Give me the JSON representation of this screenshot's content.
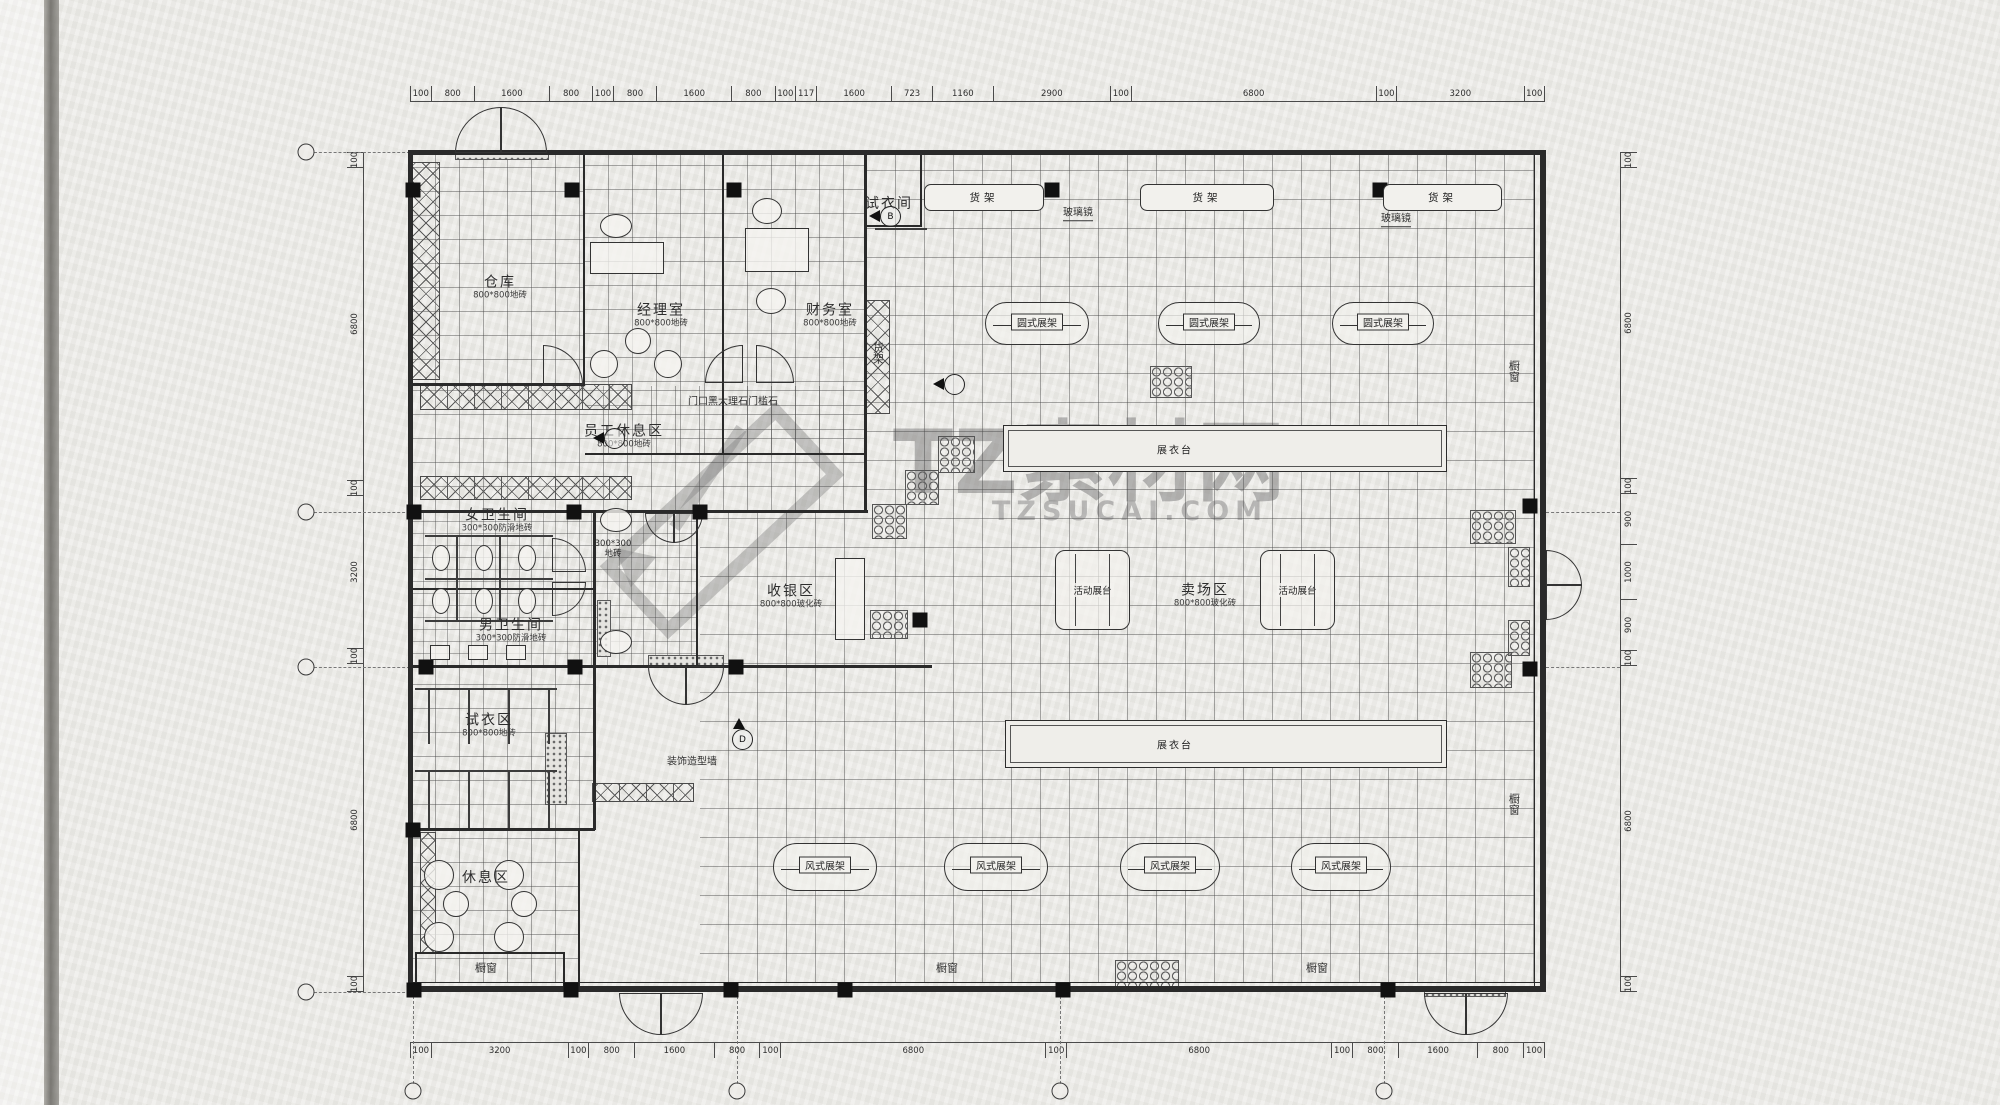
{
  "watermark": {
    "brand": "TZ素材网",
    "site": "TZSUCAI.COM",
    "logo": "pencil-icon"
  },
  "dimensions": {
    "top": [
      "100",
      "800",
      "1600",
      "800",
      "100",
      "800",
      "1600",
      "800",
      "100",
      "117",
      "1600",
      "723",
      "1160",
      "2900",
      "100",
      "6800",
      "100",
      "3200",
      "100"
    ],
    "bottom": [
      "100",
      "3200",
      "100",
      "800",
      "1600",
      "800",
      "100",
      "6800",
      "100",
      "6800",
      "100",
      "800",
      "1600",
      "800",
      "100"
    ],
    "left": [
      "100",
      "6800",
      "100",
      "3200",
      "100",
      "6800",
      "100"
    ],
    "right": [
      "100",
      "6800",
      "100",
      "900",
      "1000",
      "900",
      "100",
      "6800",
      "100"
    ]
  },
  "rooms": [
    {
      "id": "warehouse",
      "label": "仓库",
      "sub": "800*800地砖",
      "lx": 500,
      "ly": 288
    },
    {
      "id": "manager-office",
      "label": "经理室",
      "sub": "800*800地砖",
      "lx": 661,
      "ly": 316
    },
    {
      "id": "finance-office",
      "label": "财务室",
      "sub": "800*800地砖",
      "lx": 830,
      "ly": 316
    },
    {
      "id": "staff-lounge",
      "label": "员工休息区",
      "sub": "800*800地砖",
      "lx": 624,
      "ly": 437
    },
    {
      "id": "women-restroom",
      "label": "女卫生间",
      "sub": "300*300防滑地砖",
      "lx": 497,
      "ly": 521
    },
    {
      "id": "men-restroom",
      "label": "男卫生间",
      "sub": "300*300防滑地砖",
      "lx": 511,
      "ly": 631
    },
    {
      "id": "cashier-area",
      "label": "收银区",
      "sub": "800*800玻化砖",
      "lx": 791,
      "ly": 597
    },
    {
      "id": "fitting-area",
      "label": "试衣区",
      "sub": "800*800地砖",
      "lx": 489,
      "ly": 726
    },
    {
      "id": "lounge-area",
      "label": "休息区",
      "sub": "",
      "lx": 486,
      "ly": 879
    },
    {
      "id": "sales-area",
      "label": "卖场区",
      "sub": "800*800玻化砖",
      "lx": 1205,
      "ly": 596
    },
    {
      "id": "fitting-room",
      "label": "试衣间",
      "sub": "",
      "lx": 889,
      "ly": 205
    }
  ],
  "corridor_note": {
    "text": "300*300\n地砖",
    "x": 613,
    "y": 550
  },
  "notes": [
    {
      "id": "threshold-note",
      "text": "门口黑大理石门槛石",
      "x": 733,
      "y": 402,
      "fs": 10
    },
    {
      "id": "decor-wall-note",
      "text": "装饰造型墙",
      "x": 692,
      "y": 762,
      "fs": 10
    },
    {
      "id": "shelf-note-vertical",
      "text": "货架",
      "x": 877,
      "y": 353,
      "fs": 11,
      "vertical": true
    },
    {
      "id": "mirror-note-1",
      "text": "玻璃镜",
      "x": 1078,
      "y": 214,
      "fs": 10,
      "underline": true
    },
    {
      "id": "mirror-note-2",
      "text": "玻璃镜",
      "x": 1396,
      "y": 220,
      "fs": 10,
      "underline": true
    },
    {
      "id": "window-note-1",
      "text": "橱窗",
      "x": 486,
      "y": 969,
      "fs": 11
    },
    {
      "id": "window-note-2",
      "text": "橱窗",
      "x": 947,
      "y": 969,
      "fs": 11
    },
    {
      "id": "window-note-3",
      "text": "橱窗",
      "x": 1317,
      "y": 969,
      "fs": 11
    },
    {
      "id": "window-note-4",
      "text": "橱窗",
      "x": 1513,
      "y": 371,
      "fs": 11,
      "vertical": true
    },
    {
      "id": "window-note-5",
      "text": "橱窗",
      "x": 1513,
      "y": 804,
      "fs": 11,
      "vertical": true
    }
  ],
  "shelf_boxes": [
    {
      "label": "货架",
      "x": 924,
      "y": 184,
      "w": 118,
      "h": 25
    },
    {
      "label": "货架",
      "x": 1140,
      "y": 184,
      "w": 132,
      "h": 25
    },
    {
      "label": "货架",
      "x": 1383,
      "y": 184,
      "w": 117,
      "h": 25
    }
  ],
  "round_racks": [
    {
      "label": "圆式展架",
      "x": 985,
      "y": 302,
      "w": 102,
      "h": 41
    },
    {
      "label": "圆式展架",
      "x": 1158,
      "y": 302,
      "w": 100,
      "h": 41
    },
    {
      "label": "圆式展架",
      "x": 1332,
      "y": 302,
      "w": 100,
      "h": 41
    }
  ],
  "wind_racks": [
    {
      "label": "风式展架",
      "x": 773,
      "y": 843,
      "w": 102,
      "h": 46
    },
    {
      "label": "风式展架",
      "x": 944,
      "y": 843,
      "w": 102,
      "h": 46
    },
    {
      "label": "风式展架",
      "x": 1120,
      "y": 843,
      "w": 98,
      "h": 46
    },
    {
      "label": "风式展架",
      "x": 1291,
      "y": 843,
      "w": 98,
      "h": 46
    }
  ],
  "movable_stages": [
    {
      "label": "活动展台",
      "x": 1055,
      "y": 550,
      "w": 73,
      "h": 78
    },
    {
      "label": "活动展台",
      "x": 1260,
      "y": 550,
      "w": 73,
      "h": 78
    }
  ],
  "display_tables": [
    {
      "label": "展衣台",
      "x": 1003,
      "y": 425,
      "w": 442,
      "h": 45,
      "loff": 150
    },
    {
      "label": "展衣台",
      "x": 1005,
      "y": 720,
      "w": 440,
      "h": 46,
      "loff": 148
    }
  ],
  "markers": [
    {
      "x": 888,
      "y": 218,
      "dir": "left",
      "letter": "B"
    },
    {
      "x": 952,
      "y": 386,
      "dir": "left",
      "letter": ""
    },
    {
      "x": 612,
      "y": 440,
      "dir": "left",
      "letter": ""
    },
    {
      "x": 740,
      "y": 741,
      "dir": "up",
      "letter": "D"
    }
  ],
  "columns": [
    [
      413,
      190
    ],
    [
      572,
      190
    ],
    [
      734,
      190
    ],
    [
      1052,
      190
    ],
    [
      1380,
      190
    ],
    [
      414,
      512
    ],
    [
      574,
      512
    ],
    [
      700,
      512
    ],
    [
      426,
      667
    ],
    [
      575,
      667
    ],
    [
      736,
      667
    ],
    [
      920,
      620
    ],
    [
      1530,
      506
    ],
    [
      1530,
      669
    ],
    [
      413,
      830
    ],
    [
      414,
      990
    ],
    [
      571,
      990
    ],
    [
      731,
      990
    ],
    [
      845,
      990
    ],
    [
      1063,
      990
    ],
    [
      1388,
      990
    ]
  ],
  "hex_patches": [
    [
      938,
      436,
      35,
      35
    ],
    [
      905,
      470,
      32,
      33
    ],
    [
      872,
      504,
      33,
      33
    ],
    [
      870,
      610,
      36,
      27
    ],
    [
      1150,
      366,
      40,
      30
    ],
    [
      1470,
      510,
      44,
      32
    ],
    [
      1508,
      547,
      20,
      38
    ],
    [
      1508,
      620,
      20,
      34
    ],
    [
      1470,
      652,
      40,
      34
    ],
    [
      1115,
      960,
      62,
      28
    ]
  ],
  "speckles": [
    [
      648,
      655,
      74,
      9
    ],
    [
      455,
      150,
      92,
      8
    ],
    [
      1424,
      986,
      80,
      9
    ],
    [
      545,
      733,
      20,
      70
    ],
    [
      597,
      600,
      12,
      55
    ]
  ],
  "xhatch_bands": [
    [
      412,
      162,
      26,
      216
    ],
    [
      420,
      384,
      210,
      24
    ],
    [
      420,
      476,
      210,
      22
    ],
    [
      592,
      783,
      100,
      17
    ],
    [
      866,
      300,
      22,
      112
    ],
    [
      420,
      832,
      14,
      120
    ]
  ],
  "walls": [
    [
      408,
      150,
      1137,
      5
    ],
    [
      408,
      986,
      1137,
      6
    ],
    [
      408,
      150,
      5,
      842
    ],
    [
      1540,
      150,
      6,
      842
    ],
    [
      583,
      152,
      2,
      233
    ],
    [
      722,
      152,
      2,
      303
    ],
    [
      864,
      152,
      3,
      360
    ],
    [
      410,
      383,
      175,
      3
    ],
    [
      585,
      453,
      281,
      2
    ],
    [
      410,
      510,
      458,
      3
    ],
    [
      593,
      512,
      3,
      318
    ],
    [
      696,
      512,
      2,
      155
    ],
    [
      410,
      588,
      185,
      2
    ],
    [
      410,
      665,
      522,
      3
    ],
    [
      410,
      828,
      185,
      3
    ],
    [
      578,
      830,
      2,
      160
    ],
    [
      864,
      225,
      58,
      2
    ],
    [
      920,
      152,
      2,
      75
    ],
    [
      415,
      952,
      150,
      2
    ],
    [
      415,
      952,
      2,
      36
    ],
    [
      563,
      952,
      2,
      36
    ],
    [
      1534,
      152,
      1,
      840
    ],
    [
      410,
      982,
      1131,
      1
    ]
  ],
  "doors": [
    {
      "x": 455,
      "y": 107,
      "r": 44,
      "c": "tl"
    },
    {
      "x": 501,
      "y": 107,
      "r": 44,
      "c": "tr"
    },
    {
      "x": 619,
      "y": 993,
      "r": 40,
      "c": "bl"
    },
    {
      "x": 661,
      "y": 993,
      "r": 40,
      "c": "br"
    },
    {
      "x": 1424,
      "y": 993,
      "r": 40,
      "c": "bl"
    },
    {
      "x": 1466,
      "y": 993,
      "r": 40,
      "c": "br"
    },
    {
      "x": 1546,
      "y": 550,
      "r": 34,
      "c": "tr"
    },
    {
      "x": 1546,
      "y": 584,
      "r": 34,
      "c": "br"
    },
    {
      "x": 648,
      "y": 666,
      "r": 37,
      "c": "bl"
    },
    {
      "x": 685,
      "y": 666,
      "r": 37,
      "c": "br"
    },
    {
      "x": 645,
      "y": 513,
      "r": 28,
      "c": "bl"
    },
    {
      "x": 673,
      "y": 513,
      "r": 28,
      "c": "br"
    },
    {
      "x": 543,
      "y": 345,
      "r": 38,
      "c": "tr"
    },
    {
      "x": 705,
      "y": 345,
      "r": 36,
      "c": "tl"
    },
    {
      "x": 756,
      "y": 345,
      "r": 36,
      "c": "tr"
    },
    {
      "x": 552,
      "y": 538,
      "r": 32,
      "c": "tr"
    },
    {
      "x": 552,
      "y": 582,
      "r": 32,
      "c": "br"
    }
  ],
  "tile_areas": [
    {
      "cls": "tiles-lg",
      "x": 867,
      "y": 155,
      "w": 667,
      "h": 827
    },
    {
      "cls": "tiles-lg",
      "x": 700,
      "y": 513,
      "w": 167,
      "h": 469
    },
    {
      "cls": "tiles-md",
      "x": 412,
      "y": 155,
      "w": 171,
      "h": 228
    },
    {
      "cls": "tiles-md",
      "x": 585,
      "y": 155,
      "w": 137,
      "h": 298
    },
    {
      "cls": "tiles-md",
      "x": 724,
      "y": 155,
      "w": 140,
      "h": 298
    },
    {
      "cls": "tiles-md",
      "x": 412,
      "y": 386,
      "w": 452,
      "h": 124
    },
    {
      "cls": "tiles-sm",
      "x": 412,
      "y": 513,
      "w": 181,
      "h": 152
    },
    {
      "cls": "tiles-sm",
      "x": 596,
      "y": 513,
      "w": 100,
      "h": 152
    },
    {
      "cls": "tiles-md",
      "x": 412,
      "y": 668,
      "w": 181,
      "h": 160
    },
    {
      "cls": "tiles-md",
      "x": 412,
      "y": 830,
      "w": 166,
      "h": 152
    }
  ],
  "furniture": [
    {
      "k": "desk",
      "t": "rect",
      "x": 590,
      "y": 242,
      "w": 72,
      "h": 30
    },
    {
      "k": "office-chair",
      "t": "ell",
      "x": 600,
      "y": 214,
      "w": 30,
      "h": 22
    },
    {
      "k": "tea-table",
      "t": "ell",
      "x": 625,
      "y": 328,
      "w": 24,
      "h": 24
    },
    {
      "k": "sofa-chair",
      "t": "ell",
      "x": 590,
      "y": 350,
      "w": 26,
      "h": 26
    },
    {
      "k": "sofa-chair",
      "t": "ell",
      "x": 654,
      "y": 350,
      "w": 26,
      "h": 26
    },
    {
      "k": "desk",
      "t": "rect",
      "x": 745,
      "y": 228,
      "w": 62,
      "h": 42
    },
    {
      "k": "office-chair",
      "t": "ell",
      "x": 752,
      "y": 198,
      "w": 28,
      "h": 24
    },
    {
      "k": "office-chair",
      "t": "ell",
      "x": 756,
      "y": 288,
      "w": 28,
      "h": 24
    },
    {
      "k": "toilet",
      "t": "ell",
      "x": 432,
      "y": 545,
      "w": 16,
      "h": 24
    },
    {
      "k": "toilet",
      "t": "ell",
      "x": 475,
      "y": 545,
      "w": 16,
      "h": 24
    },
    {
      "k": "toilet",
      "t": "ell",
      "x": 518,
      "y": 545,
      "w": 16,
      "h": 24
    },
    {
      "k": "toilet",
      "t": "ell",
      "x": 432,
      "y": 588,
      "w": 16,
      "h": 24
    },
    {
      "k": "toilet",
      "t": "ell",
      "x": 475,
      "y": 588,
      "w": 16,
      "h": 24
    },
    {
      "k": "toilet",
      "t": "ell",
      "x": 518,
      "y": 588,
      "w": 16,
      "h": 24
    },
    {
      "k": "urinal",
      "t": "rect",
      "x": 430,
      "y": 645,
      "w": 18,
      "h": 13
    },
    {
      "k": "urinal",
      "t": "rect",
      "x": 468,
      "y": 645,
      "w": 18,
      "h": 13
    },
    {
      "k": "urinal",
      "t": "rect",
      "x": 506,
      "y": 645,
      "w": 18,
      "h": 13
    },
    {
      "k": "sink",
      "t": "ell",
      "x": 600,
      "y": 508,
      "w": 30,
      "h": 22
    },
    {
      "k": "sink",
      "t": "ell",
      "x": 600,
      "y": 630,
      "w": 30,
      "h": 22
    },
    {
      "k": "cashier-counter",
      "t": "rect",
      "x": 835,
      "y": 558,
      "w": 28,
      "h": 80
    },
    {
      "k": "round-table",
      "t": "ell",
      "x": 443,
      "y": 891,
      "w": 24,
      "h": 24
    },
    {
      "k": "round-table",
      "t": "ell",
      "x": 511,
      "y": 891,
      "w": 24,
      "h": 24
    },
    {
      "k": "lounge-chair",
      "t": "ell",
      "x": 424,
      "y": 860,
      "w": 28,
      "h": 28
    },
    {
      "k": "lounge-chair",
      "t": "ell",
      "x": 494,
      "y": 860,
      "w": 28,
      "h": 28
    },
    {
      "k": "lounge-chair",
      "t": "ell",
      "x": 424,
      "y": 922,
      "w": 28,
      "h": 28
    },
    {
      "k": "lounge-chair",
      "t": "ell",
      "x": 494,
      "y": 922,
      "w": 28,
      "h": 28
    }
  ],
  "thin_lines": [
    [
      425,
      535,
      128,
      2
    ],
    [
      425,
      578,
      128,
      2
    ],
    [
      425,
      620,
      128,
      2
    ],
    [
      456,
      535,
      2,
      43
    ],
    [
      499,
      535,
      2,
      43
    ],
    [
      456,
      578,
      2,
      43
    ],
    [
      499,
      578,
      2,
      43
    ],
    [
      415,
      688,
      142,
      2
    ],
    [
      415,
      770,
      142,
      2
    ],
    [
      428,
      688,
      2,
      56
    ],
    [
      468,
      688,
      2,
      56
    ],
    [
      508,
      688,
      2,
      56
    ],
    [
      548,
      688,
      2,
      56
    ],
    [
      428,
      772,
      2,
      56
    ],
    [
      468,
      772,
      2,
      56
    ],
    [
      508,
      772,
      2,
      56
    ],
    [
      548,
      772,
      2,
      56
    ],
    [
      875,
      228,
      52,
      2
    ]
  ],
  "axis_bubbles": {
    "left_x": 306,
    "left_ys": [
      152,
      512,
      667,
      992
    ],
    "bottom_y": 1091,
    "bottom_xs": [
      413,
      737,
      1060,
      1384
    ]
  }
}
